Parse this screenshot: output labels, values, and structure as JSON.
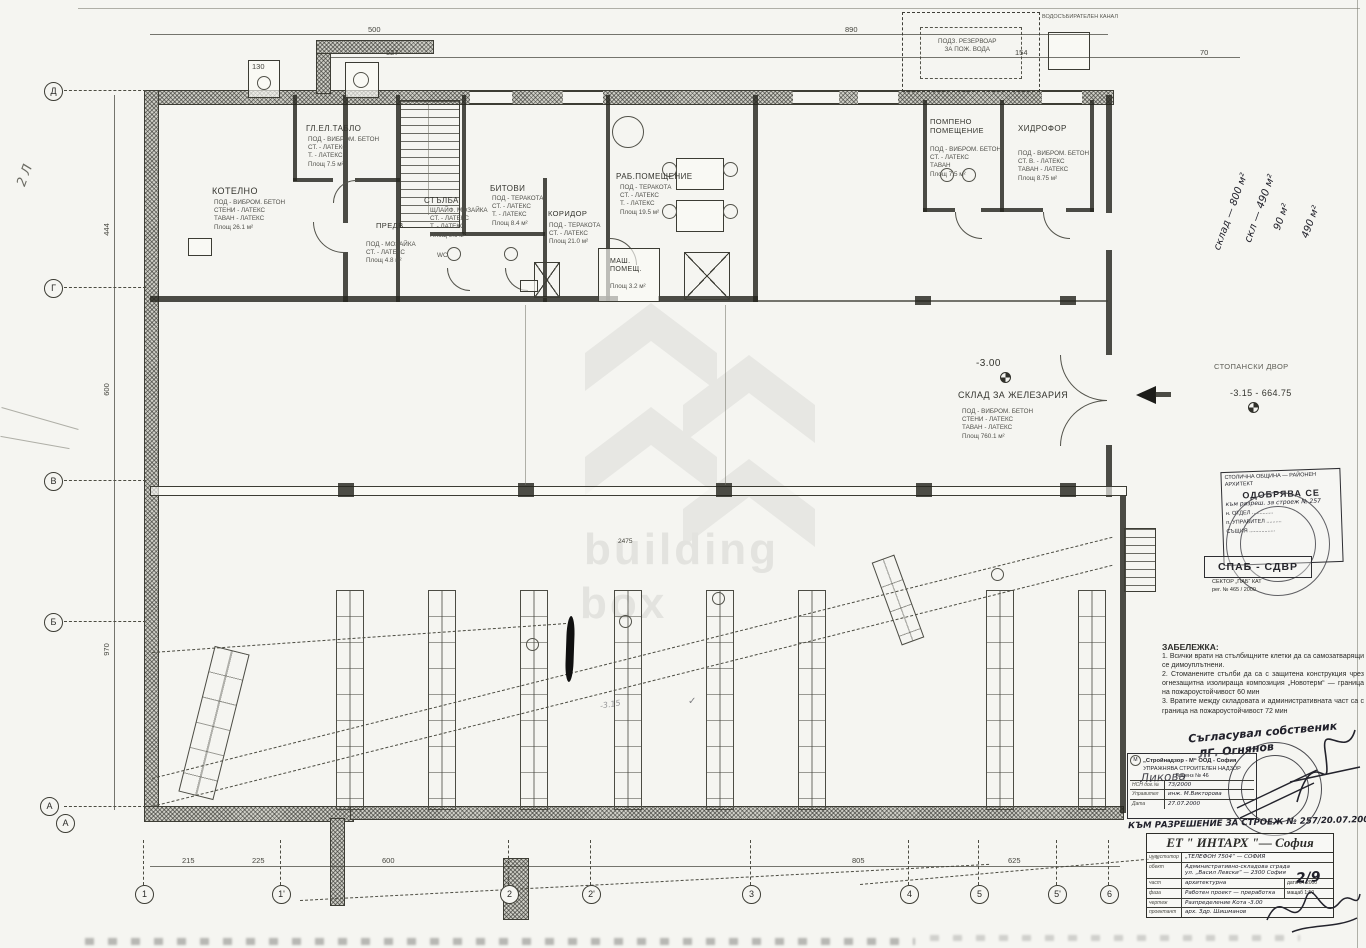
{
  "watermark": {
    "line1": "building",
    "line2": "box"
  },
  "axes": {
    "left": {
      "a1": "Д",
      "a2": "Г",
      "a3": "В",
      "a4": "Б",
      "a5": "А",
      "a6": "А"
    },
    "bottom": {
      "b1": "1",
      "b2": "1'",
      "b3": "2",
      "b4": "2'",
      "b5": "3",
      "b6": "4",
      "b7": "5",
      "b8": "5'",
      "b9": "6"
    }
  },
  "dims": {
    "top1": "500",
    "top2": "890",
    "top3": "527",
    "top4": "154",
    "top5": "70",
    "chimney": "130",
    "left1": "444",
    "left2": "600",
    "left3": "970",
    "mid1": "2475",
    "bottom1": "215",
    "bottom2": "225",
    "bottom3": "600",
    "bottom4": "805",
    "bottom5": "625"
  },
  "rooms": {
    "kotelno": {
      "name": "КОТЕЛНО",
      "spec": "ПОД - ВИБРОМ. БЕТОН\nСТЕНИ - ЛАТЕКС\nТАВАН - ЛАТЕКС\nПлощ 26.1 м²"
    },
    "gl_tablo": {
      "name": "ГЛ.ЕЛ.ТАБЛО",
      "spec": "ПОД - ВИБРОМ. БЕТОН\nСТ. - ЛАТЕКС\nТ. - ЛАТЕКС\nПлощ 7.5 м²"
    },
    "stalba": {
      "name": "СТЪЛБА",
      "spec": "ЩЛАЙФ. МОЗАЙКА\nСТ. - ЛАТЕКС\nТ. - ЛАТЕКС\nПлощ 9.6 м²"
    },
    "predv": {
      "name": "ПРЕДВ.",
      "spec": "ПОД - МОЗАЙКА\nСТ. - ЛАТЕКС\nПлощ 4.8 м²"
    },
    "bitovi": {
      "name": "БИТОВИ",
      "spec": "ПОД - ТЕРАКОТА\nСТ. - ЛАТЕКС\nТ. - ЛАТЕКС\nПлощ 8.4 м²"
    },
    "koridor": {
      "name": "КОРИДОР",
      "spec": "ПОД - ТЕРАКОТА\nСТ. - ЛАТЕКС\nПлощ 21.0 м²"
    },
    "rab_pom": {
      "name": "РАБ.ПОМЕЩЕНИЕ",
      "spec": "ПОД - ТЕРАКОТА\nСТ. - ЛАТЕКС\nТ. - ЛАТЕКС\nПлощ 19.5 м²"
    },
    "mash_pom": {
      "name": "МАШ.\nПОМЕЩ.",
      "spec": "Площ 3.2 м²"
    },
    "wc": {
      "name": "WC"
    },
    "pompeno": {
      "name": "ПОМПЕНО\nПОМЕЩЕНИЕ",
      "spec": "ПОД - ВИБРОМ. БЕТОН\nСТ. - ЛАТЕКС\nТАВАН\nПлощ 7.5 м²"
    },
    "hidrofor": {
      "name": "ХИДРОФОР",
      "spec": "ПОД - ВИБРОМ. БЕТОН\nСТ. В. - ЛАТЕКС\nТАВАН - ЛАТЕКС\nПлощ 8.75 м²"
    },
    "sklad": {
      "name": "СКЛАД ЗА ЖЕЛЕЗАРИЯ",
      "level": "-3.00",
      "spec": "ПОД - ВИБРОМ. БЕТОН\nСТЕНИ - ЛАТЕКС\nТАВАН - ЛАТЕКС\nПлощ 760.1 м²"
    },
    "yard": {
      "name": "СТОПАНСКИ ДВОР",
      "level": "-3.15 - 664.75"
    },
    "reservoir": {
      "name": "ПОДЗ. РЕЗЕРВОАР\nЗА ПОЖ. ВОДА"
    },
    "canal": {
      "name": "ВОДОСЪБИРАТЕЛЕН КАНАЛ"
    }
  },
  "handwritten": {
    "area1": "склад — 800 м²",
    "area2": "скл — 490 м²",
    "area3": "90 м²",
    "area4": "490 м²",
    "margin": "2 Л",
    "pencil_level": "-3.15",
    "check": "✓",
    "agreement1": "Съгласувал собственик",
    "agreement2": "ЛГ. Огнянов",
    "permit": "КЪМ РАЗРЕШЕНИЕ ЗА СТРОЕЖ № 257/20.07.2000",
    "likova": "Ликова"
  },
  "notes": {
    "title": "ЗАБЕЛЕЖКА:",
    "n1": "1. Всички врати на стълбищните клетки да са самозатварящи се димоуплътнени.",
    "n2": "2. Стоманените стълби да са с защитена конструкция чрез огнезащитна изолираща композиция „Новотерм“ — граница на пожароустойчивост 60 мин",
    "n3": "3. Вратите между складовата и административната част са с граница на пожароустойчивост 72 мин"
  },
  "approval_stamp": {
    "header": "СТОЛИЧНА ОБЩИНА — РАЙОНЕН АРХИТЕКТ",
    "title": "ОДОБРЯВА СЕ",
    "sub": "към разреш. за строеж № 257",
    "row1": "н. ОТДЕЛ ..............",
    "row2": "п. УПРАВИТЕЛ ..........",
    "row3": "СЪЩИЯ ................."
  },
  "spab_stamp": {
    "title": "СПАБ - СДВР",
    "line1": "СЕКТОР „ПАБ“ КАТ",
    "line2": "рег. № 465 / 2000"
  },
  "nadzor_stamp": {
    "logo": "М",
    "company": "„Стройнадзор - М“ ООД - София",
    "line1": "УПРАЖНЯВА СТРОИТЕЛЕН НАДЗОР",
    "license": "Лиценз № 46",
    "r1l": "НСН дог.№",
    "r1v": "73/2000",
    "r2l": "Управител",
    "r2v": "инж. М.Викторова",
    "r3l": "Печат",
    "r3v": "",
    "r4l": "Дата",
    "r4v": "27.07.2000"
  },
  "title_block": {
    "company": "ЕТ \" ИНТАРХ \"— София",
    "r1l": "инвеститор",
    "r1v": "„ТЕЛЕФОН 7504“ — СОФИЯ",
    "r2l": "обект",
    "r2v": "Административно-складова сграда\nул. „Васил Левски“ — 2300 София",
    "r3l": "част",
    "r3v": "архитектурна",
    "r3e": "дата 04.2000",
    "r4l": "фаза",
    "r4v": "Работен проект — преработка",
    "r4e": "мащаб 1:50",
    "r5l": "чертеж",
    "r5v": "Разпределение Кота -3.00",
    "r6l": "проектант",
    "r6v": "арх. Здр. Шишманов",
    "sheet": "2/9"
  }
}
